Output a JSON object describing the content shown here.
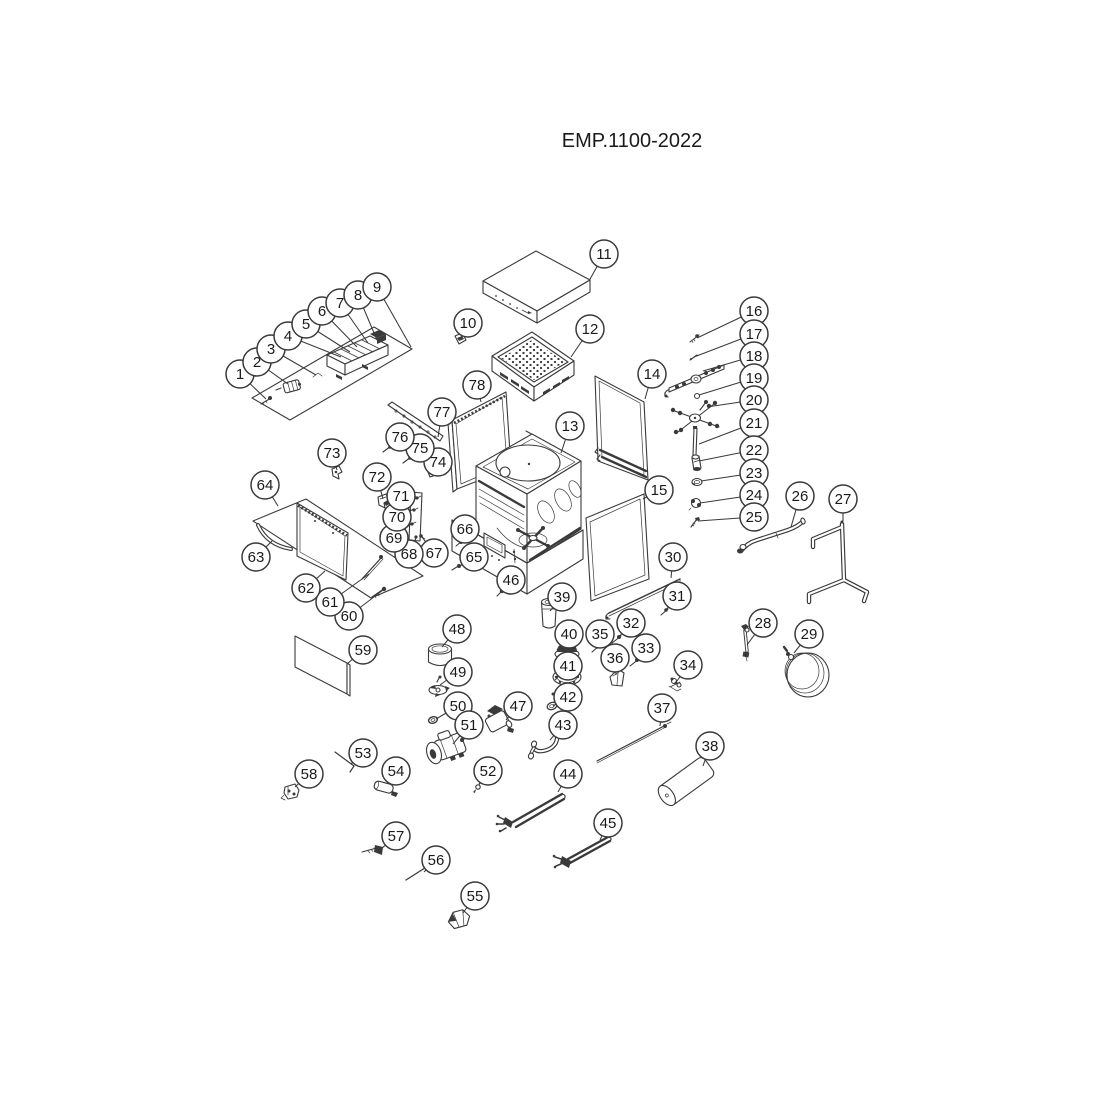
{
  "title": "EMP.1100-2022",
  "colors": {
    "background": "#ffffff",
    "line": "#3a3a3a",
    "callout_fill": "#ffffff",
    "text": "#1a1a1a"
  },
  "callouts": [
    {
      "n": "1",
      "x": 240,
      "y": 374,
      "tx": 266,
      "ty": 399
    },
    {
      "n": "2",
      "x": 257,
      "y": 362,
      "tx": 288,
      "ty": 384
    },
    {
      "n": "3",
      "x": 271,
      "y": 349,
      "tx": 316,
      "ty": 375
    },
    {
      "n": "4",
      "x": 288,
      "y": 336,
      "tx": 341,
      "ty": 357
    },
    {
      "n": "5",
      "x": 306,
      "y": 324,
      "tx": 350,
      "ty": 352
    },
    {
      "n": "6",
      "x": 322,
      "y": 311,
      "tx": 357,
      "ty": 347
    },
    {
      "n": "7",
      "x": 340,
      "y": 303,
      "tx": 368,
      "ty": 343
    },
    {
      "n": "8",
      "x": 358,
      "y": 295,
      "tx": 377,
      "ty": 340
    },
    {
      "n": "9",
      "x": 377,
      "y": 287,
      "tx": 411,
      "ty": 347
    },
    {
      "n": "10",
      "x": 468,
      "y": 323,
      "tx": 461,
      "ty": 338
    },
    {
      "n": "11",
      "x": 604,
      "y": 254,
      "tx": 589,
      "ty": 281
    },
    {
      "n": "12",
      "x": 590,
      "y": 329,
      "tx": 571,
      "ty": 357
    },
    {
      "n": "13",
      "x": 570,
      "y": 426,
      "tx": 561,
      "ty": 453
    },
    {
      "n": "14",
      "x": 652,
      "y": 374,
      "tx": 645,
      "ty": 399
    },
    {
      "n": "15",
      "x": 659,
      "y": 490,
      "tx": 643,
      "ty": 499
    },
    {
      "n": "16",
      "x": 754,
      "y": 311,
      "tx": 697,
      "ty": 338
    },
    {
      "n": "17",
      "x": 754,
      "y": 334,
      "tx": 694,
      "ty": 357
    },
    {
      "n": "18",
      "x": 754,
      "y": 356,
      "tx": 703,
      "ty": 371
    },
    {
      "n": "19",
      "x": 754,
      "y": 378,
      "tx": 699,
      "ty": 395
    },
    {
      "n": "20",
      "x": 754,
      "y": 400,
      "tx": 707,
      "ty": 407
    },
    {
      "n": "21",
      "x": 754,
      "y": 423,
      "tx": 699,
      "ty": 444
    },
    {
      "n": "22",
      "x": 754,
      "y": 450,
      "tx": 699,
      "ty": 461
    },
    {
      "n": "23",
      "x": 754,
      "y": 473,
      "tx": 701,
      "ty": 481
    },
    {
      "n": "24",
      "x": 754,
      "y": 495,
      "tx": 700,
      "ty": 503
    },
    {
      "n": "25",
      "x": 754,
      "y": 517,
      "tx": 698,
      "ty": 521
    },
    {
      "n": "26",
      "x": 800,
      "y": 496,
      "tx": 791,
      "ty": 527
    },
    {
      "n": "27",
      "x": 843,
      "y": 499,
      "tx": 843,
      "ty": 521
    },
    {
      "n": "28",
      "x": 763,
      "y": 623,
      "tx": 747,
      "ty": 645
    },
    {
      "n": "29",
      "x": 809,
      "y": 634,
      "tx": 794,
      "ty": 653
    },
    {
      "n": "30",
      "x": 673,
      "y": 557,
      "tx": 671,
      "ty": 578
    },
    {
      "n": "31",
      "x": 677,
      "y": 596,
      "tx": 666,
      "ty": 610
    },
    {
      "n": "32",
      "x": 631,
      "y": 623,
      "tx": 619,
      "ty": 637
    },
    {
      "n": "33",
      "x": 646,
      "y": 648,
      "tx": 637,
      "ty": 660
    },
    {
      "n": "34",
      "x": 688,
      "y": 665,
      "tx": 677,
      "ty": 681
    },
    {
      "n": "35",
      "x": 600,
      "y": 634,
      "tx": 597,
      "ty": 647
    },
    {
      "n": "36",
      "x": 615,
      "y": 658,
      "tx": 616,
      "ty": 675
    },
    {
      "n": "37",
      "x": 662,
      "y": 708,
      "tx": 660,
      "ty": 726
    },
    {
      "n": "38",
      "x": 710,
      "y": 746,
      "tx": 703,
      "ty": 766
    },
    {
      "n": "39",
      "x": 562,
      "y": 597,
      "tx": 550,
      "ty": 611
    },
    {
      "n": "40",
      "x": 569,
      "y": 634,
      "tx": 557,
      "ty": 650
    },
    {
      "n": "41",
      "x": 568,
      "y": 666,
      "tx": 555,
      "ty": 680
    },
    {
      "n": "42",
      "x": 568,
      "y": 697,
      "tx": 553,
      "ty": 706
    },
    {
      "n": "43",
      "x": 563,
      "y": 725,
      "tx": 550,
      "ty": 740
    },
    {
      "n": "44",
      "x": 568,
      "y": 774,
      "tx": 558,
      "ty": 792
    },
    {
      "n": "45",
      "x": 608,
      "y": 823,
      "tx": 600,
      "ty": 840
    },
    {
      "n": "46",
      "x": 511,
      "y": 580,
      "tx": 502,
      "ty": 591
    },
    {
      "n": "47",
      "x": 518,
      "y": 706,
      "tx": 506,
      "ty": 720
    },
    {
      "n": "48",
      "x": 457,
      "y": 629,
      "tx": 442,
      "ty": 647
    },
    {
      "n": "49",
      "x": 458,
      "y": 672,
      "tx": 440,
      "ty": 685
    },
    {
      "n": "50",
      "x": 458,
      "y": 706,
      "tx": 436,
      "ty": 719
    },
    {
      "n": "51",
      "x": 469,
      "y": 725,
      "tx": 453,
      "ty": 744
    },
    {
      "n": "52",
      "x": 488,
      "y": 771,
      "tx": 479,
      "ty": 784
    },
    {
      "n": "53",
      "x": 363,
      "y": 753,
      "tx": 351,
      "ty": 764
    },
    {
      "n": "54",
      "x": 396,
      "y": 771,
      "tx": 388,
      "ty": 783
    },
    {
      "n": "55",
      "x": 475,
      "y": 896,
      "tx": 463,
      "ty": 913
    },
    {
      "n": "56",
      "x": 436,
      "y": 860,
      "tx": 424,
      "ty": 872
    },
    {
      "n": "57",
      "x": 396,
      "y": 836,
      "tx": 381,
      "ty": 849
    },
    {
      "n": "58",
      "x": 309,
      "y": 774,
      "tx": 295,
      "ty": 787
    },
    {
      "n": "59",
      "x": 363,
      "y": 650,
      "tx": 347,
      "ty": 664
    },
    {
      "n": "60",
      "x": 349,
      "y": 616,
      "tx": 383,
      "ty": 590
    },
    {
      "n": "61",
      "x": 330,
      "y": 602,
      "tx": 369,
      "ty": 574
    },
    {
      "n": "62",
      "x": 306,
      "y": 588,
      "tx": 325,
      "ty": 571
    },
    {
      "n": "63",
      "x": 256,
      "y": 557,
      "tx": 272,
      "ty": 541
    },
    {
      "n": "64",
      "x": 265,
      "y": 485,
      "tx": 278,
      "ty": 506
    },
    {
      "n": "65",
      "x": 474,
      "y": 557,
      "tx": 460,
      "ty": 566
    },
    {
      "n": "66",
      "x": 465,
      "y": 529,
      "tx": 461,
      "ty": 542
    },
    {
      "n": "67",
      "x": 434,
      "y": 553,
      "tx": 422,
      "ty": 537
    },
    {
      "n": "68",
      "x": 409,
      "y": 554,
      "tx": 416,
      "ty": 538
    },
    {
      "n": "69",
      "x": 394,
      "y": 538,
      "tx": 412,
      "ty": 523
    },
    {
      "n": "70",
      "x": 397,
      "y": 517,
      "tx": 414,
      "ty": 509
    },
    {
      "n": "71",
      "x": 401,
      "y": 496,
      "tx": 417,
      "ty": 497
    },
    {
      "n": "72",
      "x": 377,
      "y": 477,
      "tx": 383,
      "ty": 499
    },
    {
      "n": "73",
      "x": 332,
      "y": 453,
      "tx": 337,
      "ty": 470
    },
    {
      "n": "74",
      "x": 438,
      "y": 462,
      "tx": 431,
      "ty": 473
    },
    {
      "n": "75",
      "x": 420,
      "y": 448,
      "tx": 409,
      "ty": 459
    },
    {
      "n": "76",
      "x": 400,
      "y": 437,
      "tx": 389,
      "ty": 448
    },
    {
      "n": "77",
      "x": 442,
      "y": 412,
      "tx": 438,
      "ty": 437
    },
    {
      "n": "78",
      "x": 477,
      "y": 385,
      "tx": 481,
      "ty": 402
    }
  ]
}
